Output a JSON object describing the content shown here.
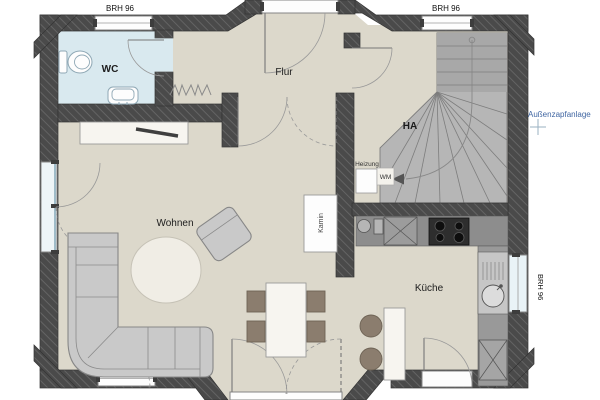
{
  "canvas": {
    "width": 600,
    "height": 400
  },
  "colors": {
    "wall": "#4a4a4a",
    "wall_hatch": "#686868",
    "floor": "#dcd8cb",
    "wc_floor": "#d9e9ef",
    "stairs": "#b6b6b6",
    "counter_dark": "#8d8d8d",
    "counter_light": "#c6c6c6",
    "furniture_gray": "#c9c9c9",
    "furniture_wood": "#8b7d6e",
    "rug": "#f0ede5",
    "annotation_blue": "#4066a2"
  },
  "rooms": {
    "wc": {
      "label": "WC"
    },
    "flur": {
      "label": "Flur"
    },
    "ha": {
      "label": "HA"
    },
    "wohnen": {
      "label": "Wohnen"
    },
    "kueche": {
      "label": "Küche"
    }
  },
  "equipment": {
    "heizung": {
      "label": "Heizung"
    },
    "wm": {
      "label": "WM"
    },
    "kamin": {
      "label": "Kamin"
    }
  },
  "annotations": {
    "brh_top_left": {
      "label": "BRH 96"
    },
    "brh_top_right": {
      "label": "BRH 96"
    },
    "brh_right": {
      "label": "BRH 96"
    },
    "aussenzapfanlage": {
      "label": "Außenzapfanlage"
    }
  }
}
